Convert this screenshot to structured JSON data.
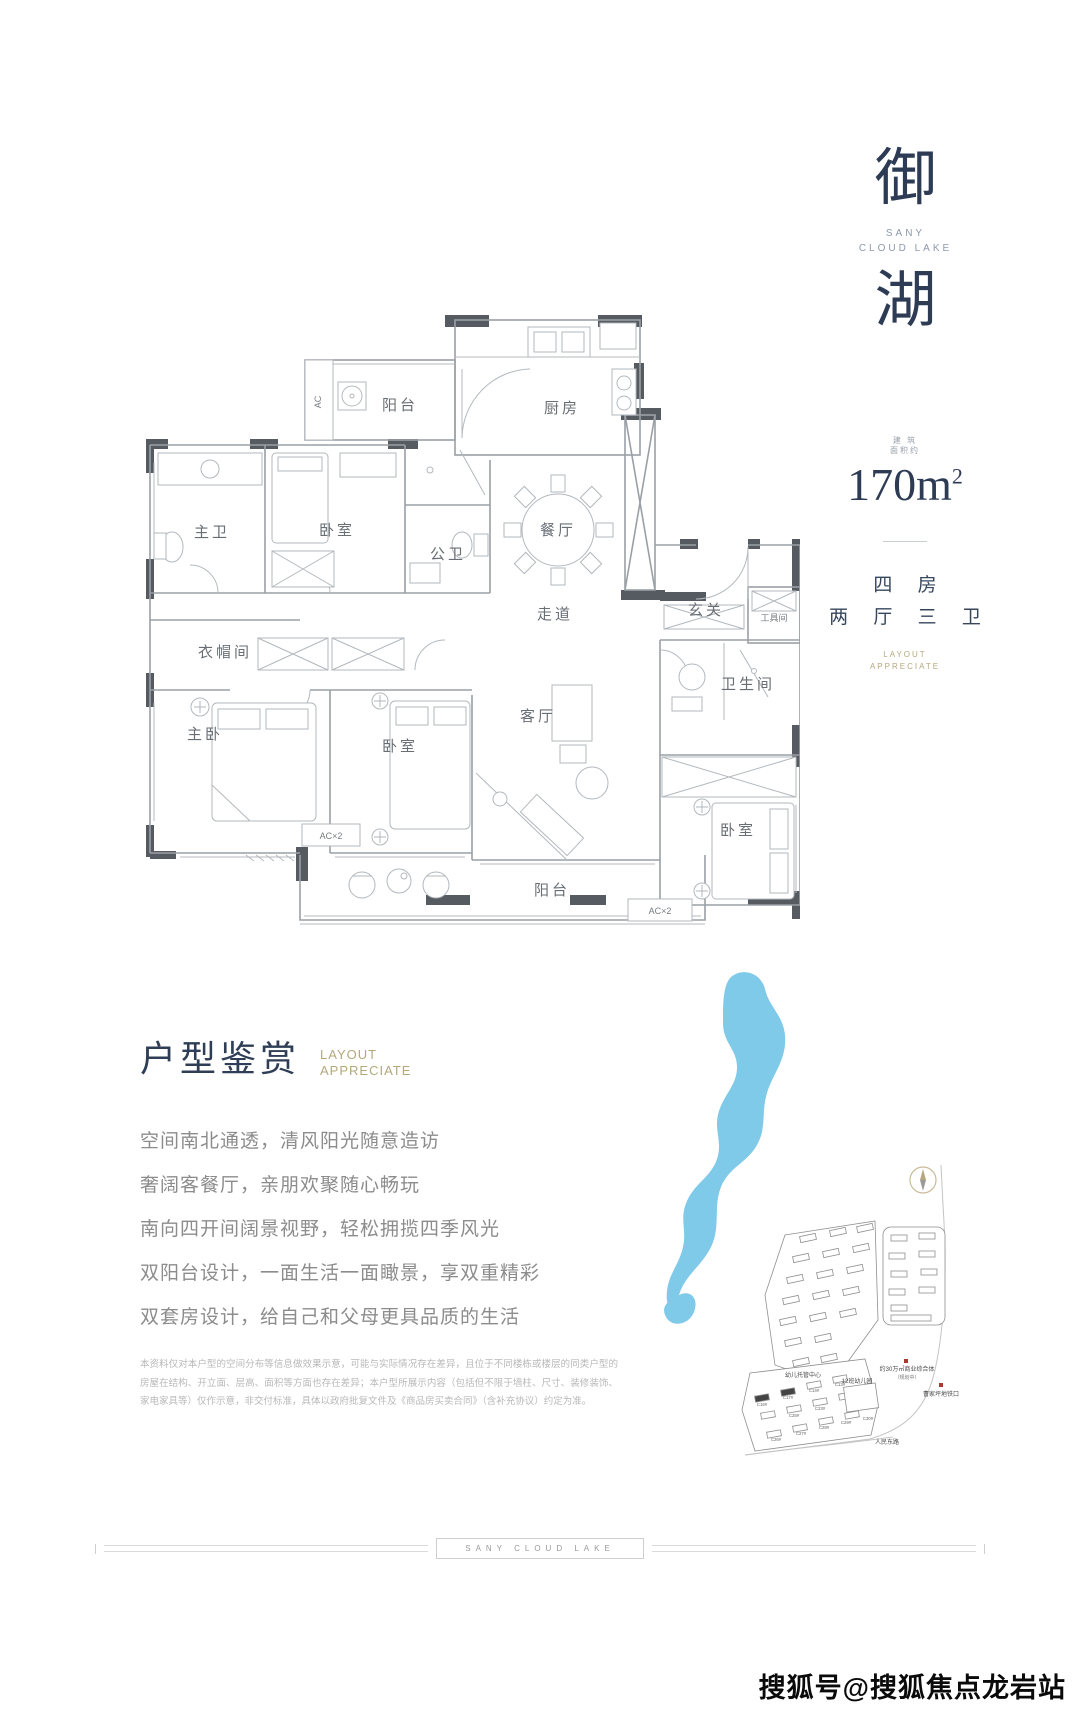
{
  "brand": {
    "char_top": "御",
    "char_bottom": "湖",
    "name_line1": "SANY",
    "name_line2": "CLOUD LAKE"
  },
  "area_info": {
    "note_line1": "建 筑",
    "note_line2": "面积约",
    "area_value": "170m",
    "area_sup": "2",
    "rooms_line1": "四 房",
    "rooms_line2": "两 厅 三 卫",
    "layout_en_line1": "LAYOUT",
    "layout_en_line2": "APPRECIATE"
  },
  "floorplan": {
    "rooms": {
      "balcony_top": "阳台",
      "kitchen": "厨房",
      "master_bath": "主卫",
      "bedroom_top": "卧室",
      "public_bath": "公卫",
      "dining": "餐厅",
      "corridor": "走道",
      "entry": "玄关",
      "tool_room": "工具间",
      "cloakroom": "衣帽间",
      "master_bedroom": "主卧",
      "bedroom_mid": "卧室",
      "living": "客厅",
      "bathroom": "卫生间",
      "bedroom_br": "卧室",
      "balcony_bottom": "阳台"
    },
    "labels": {
      "ac_vertical": "AC",
      "ac2_left": "AC×2",
      "ac2_right": "AC×2"
    }
  },
  "appreciation": {
    "title_cn": "户型鉴赏",
    "title_en_line1": "LAYOUT",
    "title_en_line2": "APPRECIATE",
    "lines": [
      "空间南北通透，清风阳光随意造访",
      "奢阔客餐厅，亲朋欢聚随心畅玩",
      "南向四开间阔景视野，轻松拥揽四季风光",
      "双阳台设计，一面生活一面瞰景，享双重精彩",
      "双套房设计，给自己和父母更具品质的生活"
    ],
    "disclaimer": "本资料仅对本户型的空间分布等信息做效果示意，可能与实际情况存在差异，且位于不同楼栋或楼层的同类户型的房屋在结构、开立面、层高、面积等方面也存在差异；本户型所展示内容（包括但不限于墙柱、尺寸、装修装饰、家电家具等）仅作示意，非交付标准，具体以政府批复文件及《商品房买卖合同》（含补充协议）约定为准。"
  },
  "map": {
    "labels": {
      "childcare": "幼儿托管中心",
      "kindergarten": "12班幼儿园",
      "commercial": "约30万㎡商业综合体",
      "commercial_note": "（规划中）",
      "metro": "曹家坪地铁口",
      "road_bottom": "人民东路"
    },
    "building_codes": [
      "C16#",
      "C17#",
      "C14#",
      "C13#",
      "C25#",
      "C23#",
      "C30#",
      "C29#",
      "C28#",
      "C27#",
      "C26#"
    ],
    "colors": {
      "lake": "#7fc9e9",
      "accent_red": "#a83b2f"
    }
  },
  "footer": {
    "brand_text": "SANY CLOUD LAKE"
  },
  "watermark": "搜狐号@搜狐焦点龙岩站",
  "colors": {
    "brand_navy": "#2d3b55",
    "gold": "#b3a87c",
    "text_gray": "#8c8c8c"
  }
}
